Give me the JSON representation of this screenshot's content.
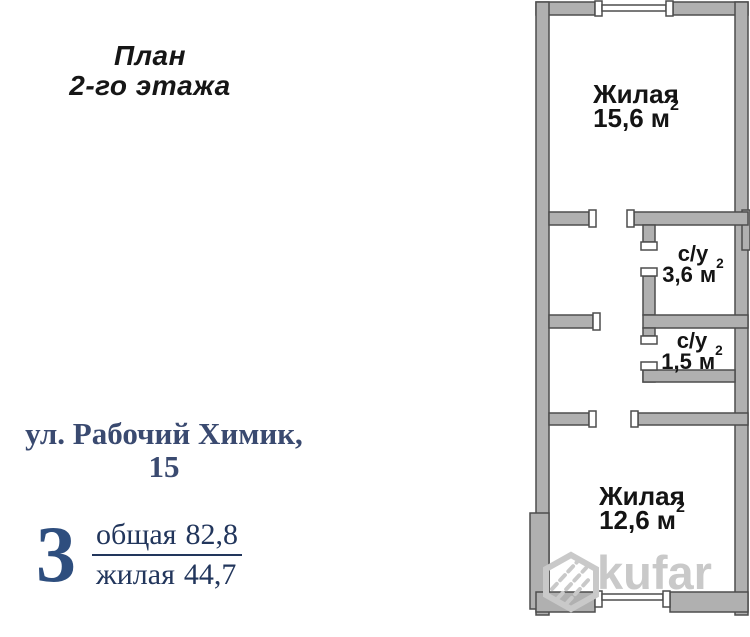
{
  "title": {
    "line1": "План",
    "line2": "2-го этажа"
  },
  "address": {
    "line1": "ул. Рабочий Химик,",
    "line2": "15"
  },
  "summary": {
    "rooms_count": "3",
    "total": {
      "label": "общая",
      "value": "82,8"
    },
    "living": {
      "label": "жилая",
      "value": "44,7"
    }
  },
  "floor_plan": {
    "rooms": [
      {
        "name": "Жилая",
        "area": "15,6",
        "unit": "м",
        "sup": "2"
      },
      {
        "name": "с/у",
        "area": "3,6",
        "unit": "м",
        "sup": "2"
      },
      {
        "name": "с/у",
        "area": "1,5",
        "unit": "м",
        "sup": "2"
      },
      {
        "name": "Жилая",
        "area": "12,6",
        "unit": "м",
        "sup": "2"
      }
    ]
  },
  "watermark": {
    "text": "kufar",
    "icon": "hexagon-logo"
  },
  "colors": {
    "wall_fill": "#b0b0b0",
    "wall_stroke": "#4d4d4d",
    "address_navy": "#3a4a70",
    "number_navy": "#2e4e7e",
    "fraction_navy": "#22365c",
    "plan_text": "#141414",
    "watermark_gray": "#c9c9c9"
  }
}
